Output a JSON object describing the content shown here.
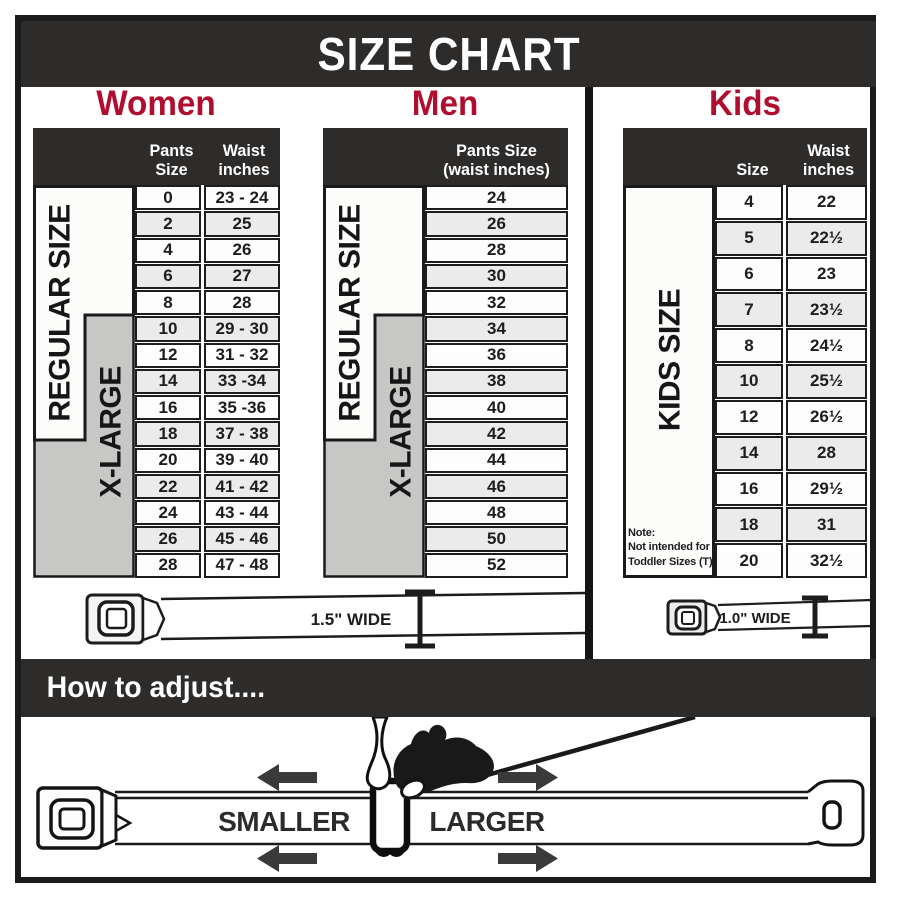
{
  "title": "SIZE CHART",
  "adjust_heading": "How to adjust....",
  "women": {
    "title": "Women",
    "col1_header": "Pants Size",
    "col2_header_line1": "Waist",
    "col2_header_line2": "inches",
    "regular_label": "REGULAR SIZE",
    "xlarge_label": "X-LARGE",
    "rows": [
      [
        "0",
        "23 - 24"
      ],
      [
        "2",
        "25"
      ],
      [
        "4",
        "26"
      ],
      [
        "6",
        "27"
      ],
      [
        "8",
        "28"
      ],
      [
        "10",
        "29 - 30"
      ],
      [
        "12",
        "31 - 32"
      ],
      [
        "14",
        "33 -34"
      ],
      [
        "16",
        "35 -36"
      ],
      [
        "18",
        "37 - 38"
      ],
      [
        "20",
        "39 - 40"
      ],
      [
        "22",
        "41 - 42"
      ],
      [
        "24",
        "43 - 44"
      ],
      [
        "26",
        "45 - 46"
      ],
      [
        "28",
        "47 - 48"
      ]
    ],
    "belt_label": "1.5\" WIDE"
  },
  "men": {
    "title": "Men",
    "header_line1": "Pants Size",
    "header_line2": "(waist inches)",
    "regular_label": "REGULAR SIZE",
    "xlarge_label": "X-LARGE",
    "rows": [
      "24",
      "26",
      "28",
      "30",
      "32",
      "34",
      "36",
      "38",
      "40",
      "42",
      "44",
      "46",
      "48",
      "50",
      "52"
    ]
  },
  "kids": {
    "title": "Kids",
    "col1_header": "Size",
    "col2_header_line1": "Waist",
    "col2_header_line2": "inches",
    "size_label": "KIDS SIZE",
    "note_lines": [
      "Note:",
      "Not intended for",
      "Toddler Sizes (T)"
    ],
    "rows": [
      [
        "4",
        "22"
      ],
      [
        "5",
        "22½"
      ],
      [
        "6",
        "23"
      ],
      [
        "7",
        "23½"
      ],
      [
        "8",
        "24½"
      ],
      [
        "10",
        "25½"
      ],
      [
        "12",
        "26½"
      ],
      [
        "14",
        "28"
      ],
      [
        "16",
        "29½"
      ],
      [
        "18",
        "31"
      ],
      [
        "20",
        "32½"
      ]
    ],
    "belt_label": "1.0\" WIDE"
  },
  "illustration": {
    "smaller_label": "SMALLER",
    "larger_label": "LARGER"
  },
  "colors": {
    "accent_red": "#b00e2f",
    "bar_dark": "#2d2c2a",
    "xlarge_gray": "#c7c7c5",
    "row_alt": "#ebebeb"
  }
}
